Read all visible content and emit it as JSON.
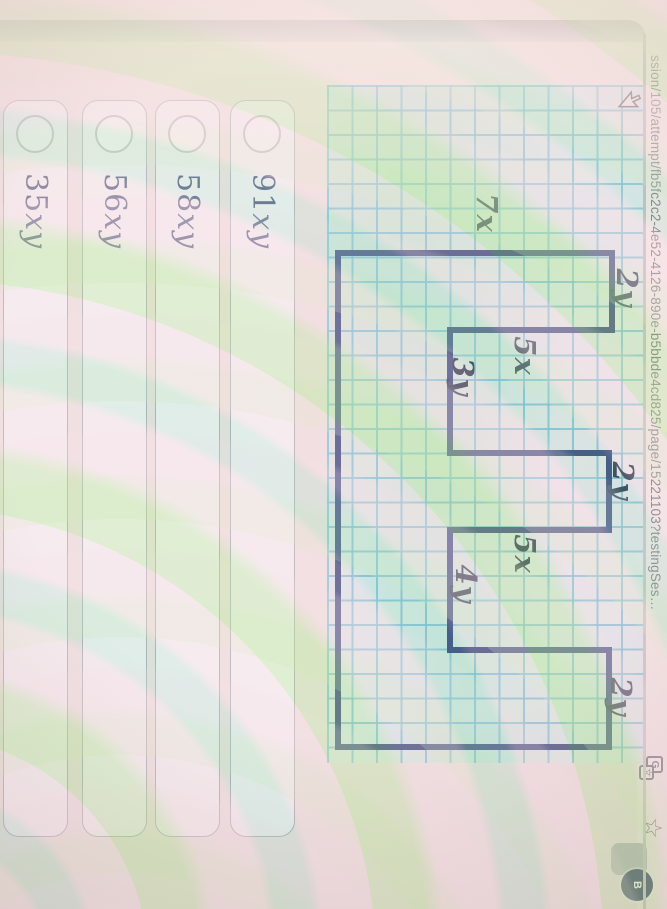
{
  "browser": {
    "url_text": "ssion/105/attempt/fb5fc2c2-4e52-4126-890e-b5bbde4cd825/page/15221103?testingSes…",
    "translate_icon_main": "G",
    "translate_icon_secondary": "文",
    "star_icon": "☆",
    "avatar_initial": "B"
  },
  "figure": {
    "polygon_points": "168,305 168,31 245,31 245,193 368,193 368,34 445,34 445,193 565,193 565,34 662,34 662,305",
    "labels": [
      {
        "text": "7x"
      },
      {
        "text": "2y"
      },
      {
        "text": "5x"
      },
      {
        "text": "3y"
      },
      {
        "text": "2y"
      },
      {
        "text": "5x"
      },
      {
        "text": "4y"
      },
      {
        "text": "2y"
      }
    ]
  },
  "options": [
    {
      "coef": "91",
      "vars": "xy"
    },
    {
      "coef": "58",
      "vars": "xy"
    },
    {
      "coef": "56",
      "vars": "xy"
    },
    {
      "coef": "35",
      "vars": "xy"
    }
  ],
  "colors": {
    "polygon_stroke": "#1e3173",
    "grid_line": "#69bad5",
    "figure_label_text": "#141f3c",
    "option_text": "#3e4a78",
    "avatar_background": "#2c3b63",
    "photo_background": "#f3e2df"
  }
}
